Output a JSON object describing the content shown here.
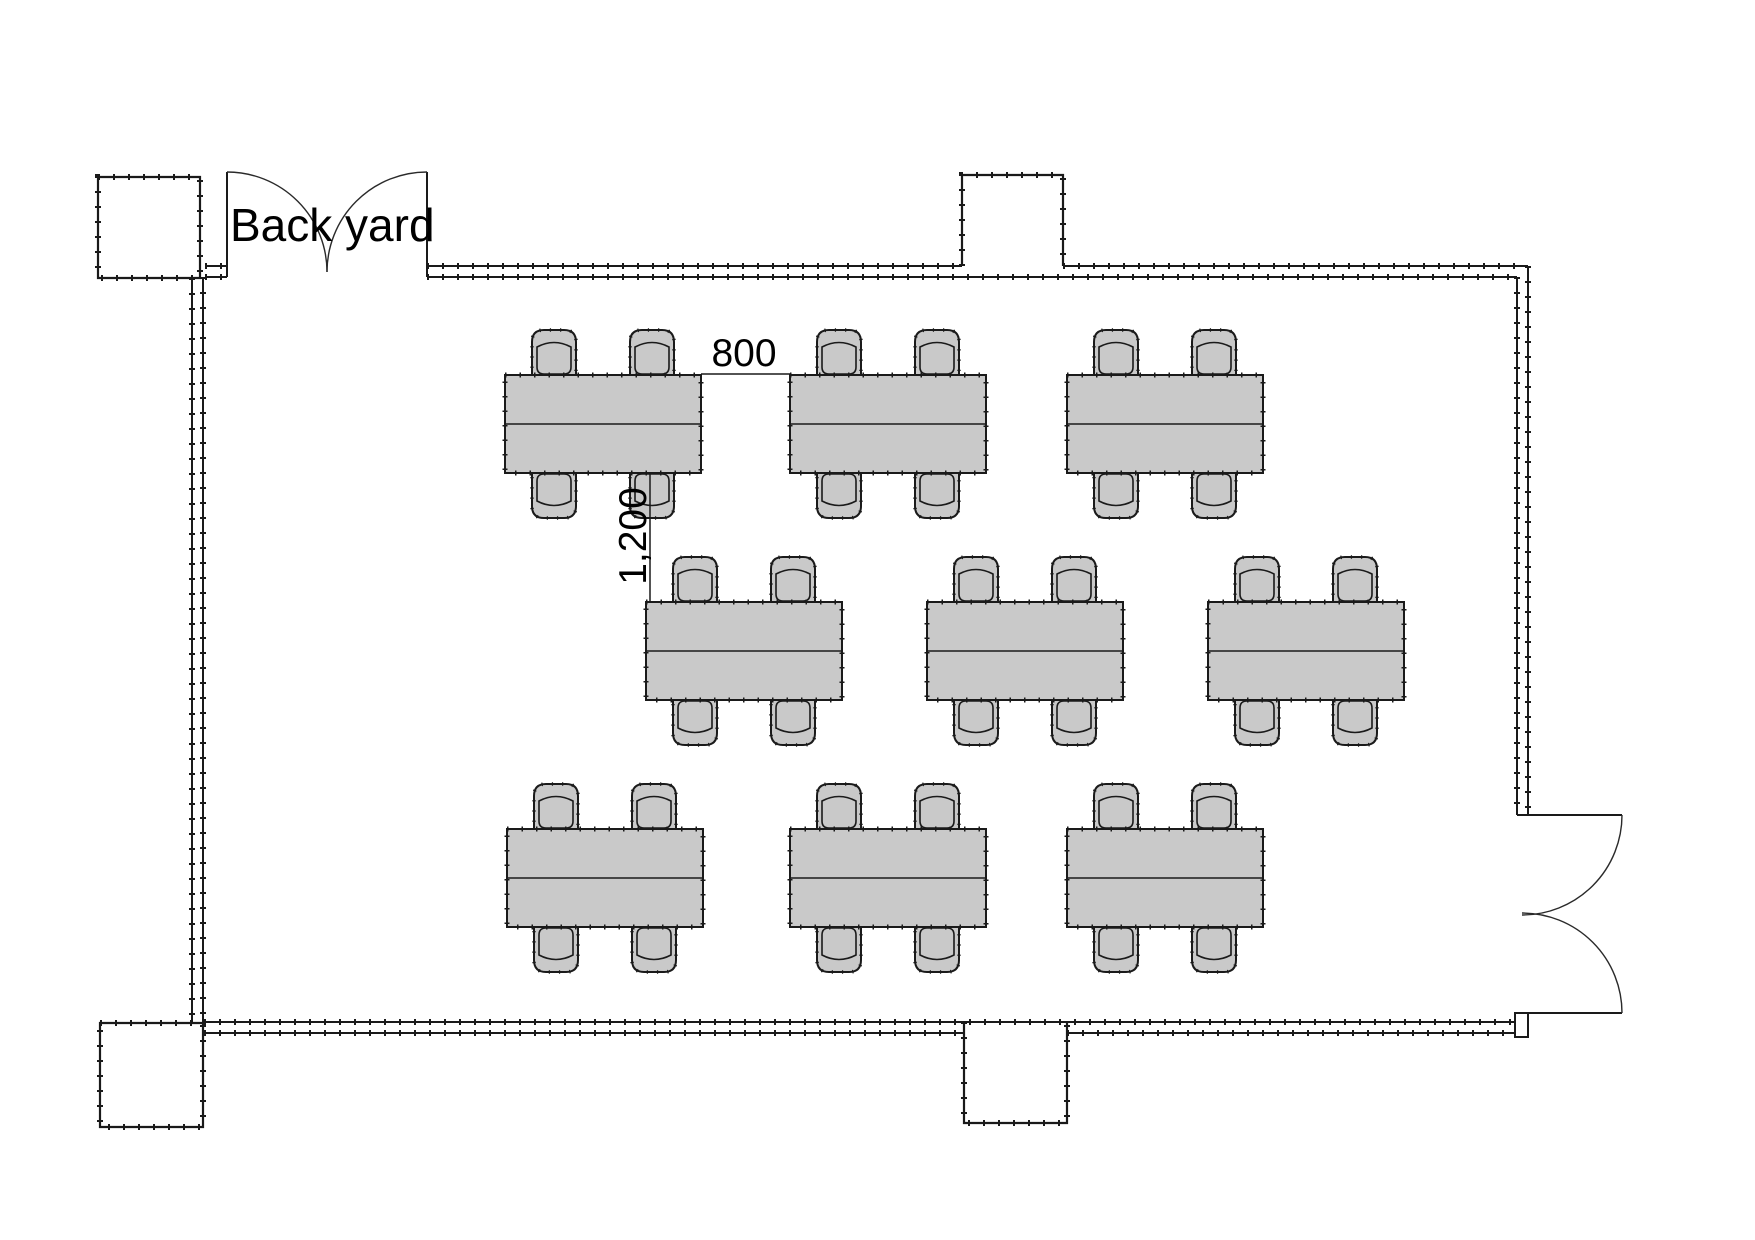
{
  "page": {
    "title": "Floor plan",
    "width": 1755,
    "height": 1240,
    "background": "#ffffff"
  },
  "labels": {
    "back_yard": "Back yard",
    "dim_gap_between_tables": "800",
    "dim_gap_between_rows": "1,200"
  },
  "colors": {
    "line": "#1a1a1a",
    "furniture_fill": "#c9c9c9",
    "pillar_fill": "#ffffff",
    "text": "#000000",
    "background": "#ffffff"
  },
  "floor_plan": {
    "wall_lines": [
      {
        "x1": 205,
        "y1": 266,
        "x2": 227,
        "y2": 266
      },
      {
        "x1": 205,
        "y1": 277,
        "x2": 227,
        "y2": 277
      },
      {
        "x1": 427,
        "y1": 266,
        "x2": 962,
        "y2": 266
      },
      {
        "x1": 1063,
        "y1": 266,
        "x2": 1528,
        "y2": 266
      },
      {
        "x1": 427,
        "y1": 277,
        "x2": 1517,
        "y2": 277
      },
      {
        "x1": 192,
        "y1": 278,
        "x2": 192,
        "y2": 1023
      },
      {
        "x1": 203,
        "y1": 277,
        "x2": 203,
        "y2": 1022
      },
      {
        "x1": 1517,
        "y1": 277,
        "x2": 1517,
        "y2": 815
      },
      {
        "x1": 1528,
        "y1": 266,
        "x2": 1528,
        "y2": 815
      },
      {
        "x1": 204,
        "y1": 1022,
        "x2": 1515,
        "y2": 1022
      },
      {
        "x1": 204,
        "y1": 1033,
        "x2": 964,
        "y2": 1033
      },
      {
        "x1": 1067,
        "y1": 1033,
        "x2": 1515,
        "y2": 1033
      }
    ],
    "pillars": [
      {
        "x": 98,
        "y": 177,
        "w": 102,
        "h": 101,
        "open": "none"
      },
      {
        "x": 962,
        "y": 175,
        "w": 101,
        "h": 91,
        "open": "bottom"
      },
      {
        "x": 100,
        "y": 1023,
        "w": 103,
        "h": 104,
        "open": "none"
      },
      {
        "x": 964,
        "y": 1022,
        "w": 103,
        "h": 101,
        "open": "top"
      }
    ],
    "jambs": [
      {
        "x": 1515,
        "y": 1013,
        "w": 13,
        "h": 24
      }
    ],
    "doors": [
      {
        "name": "backyard-double-door",
        "leaves": [
          "M227 277 L227 172",
          "M427 277 L427 172"
        ],
        "arcs": [
          "M227 172 A100 100 0 0 1 327 272",
          "M427 172 A100 100 0 0 0 327 272"
        ]
      },
      {
        "name": "entrance-double-door",
        "leaves": [
          "M1517 815 L1622 815",
          "M1517 1013 L1622 1013"
        ],
        "arcs": [
          "M1622 815 A100 100 0 0 1 1522 915",
          "M1622 1013 A100 100 0 0 0 1522 913"
        ]
      }
    ],
    "table_size": {
      "w": 196,
      "h": 98
    },
    "chair": {
      "w": 50,
      "h": 52,
      "offsets": [
        24,
        122
      ]
    },
    "tables": [
      {
        "x": 505,
        "y": 375
      },
      {
        "x": 790,
        "y": 375
      },
      {
        "x": 1067,
        "y": 375
      },
      {
        "x": 646,
        "y": 602
      },
      {
        "x": 927,
        "y": 602
      },
      {
        "x": 1208,
        "y": 602
      },
      {
        "x": 507,
        "y": 829
      },
      {
        "x": 790,
        "y": 829
      },
      {
        "x": 1067,
        "y": 829
      }
    ],
    "dimensions": [
      {
        "label_key": "dim_gap_between_tables",
        "x1": 701,
        "y1": 374,
        "x2": 790,
        "y2": 374
      },
      {
        "label_key": "dim_gap_between_rows",
        "x1": 650,
        "y1": 473,
        "x2": 650,
        "y2": 602
      }
    ]
  }
}
